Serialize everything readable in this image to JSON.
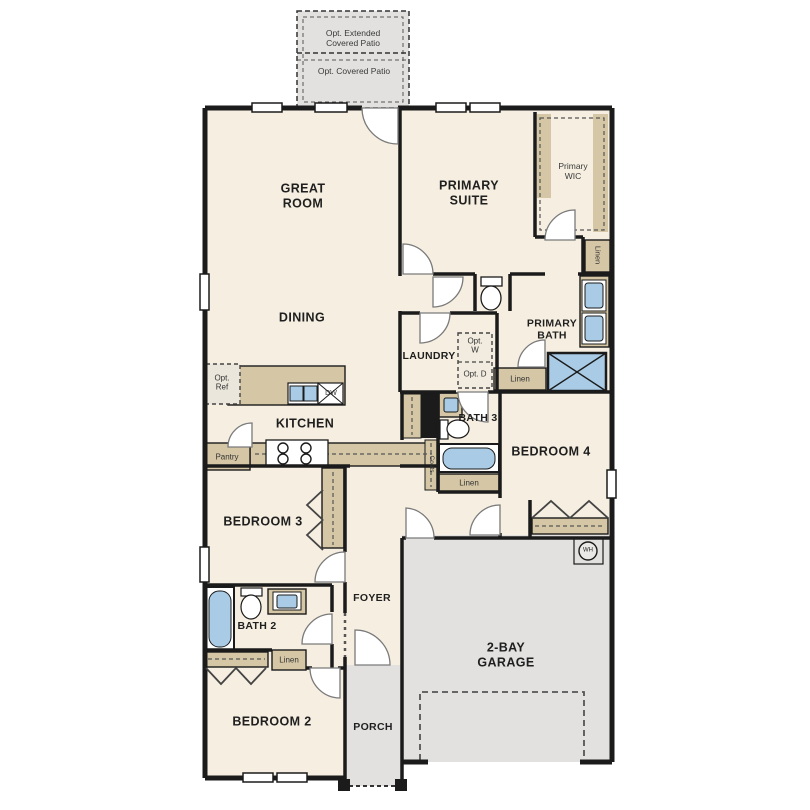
{
  "patio": {
    "extended_label": "Opt. Extended Covered Patio",
    "covered_label": "Opt. Covered Patio"
  },
  "rooms": {
    "great_room": "GREAT ROOM",
    "dining": "DINING",
    "kitchen": "KITCHEN",
    "primary_suite": "PRIMARY SUITE",
    "primary_wic": "Primary WIC",
    "primary_bath": "PRIMARY BATH",
    "laundry": "LAUNDRY",
    "bath_3": "BATH 3",
    "bedroom_4": "BEDROOM 4",
    "bedroom_3": "BEDROOM 3",
    "bath_2": "BATH 2",
    "bedroom_2": "BEDROOM 2",
    "foyer": "FOYER",
    "porch": "PORCH",
    "garage": "2-BAY GARAGE"
  },
  "closets": {
    "linen_primary_hall": "Linen",
    "linen_primary_bath": "Linen",
    "linen_bath_3": "Linen",
    "linen_bath_2": "Linen",
    "pantry": "Pantry",
    "coats": "Coats"
  },
  "options": {
    "refrigerator": "Opt. Ref",
    "washer": "Opt. W",
    "dryer": "Opt. D"
  },
  "appliances": {
    "dishwasher": "DW",
    "water_heater": "WH"
  },
  "colors": {
    "floor": "#f6efe1",
    "cabinetry": "#d5c7a5",
    "concrete": "#e2e1df",
    "fixture_blue": "#a9cbe6",
    "wall": "#1b1b1b"
  }
}
